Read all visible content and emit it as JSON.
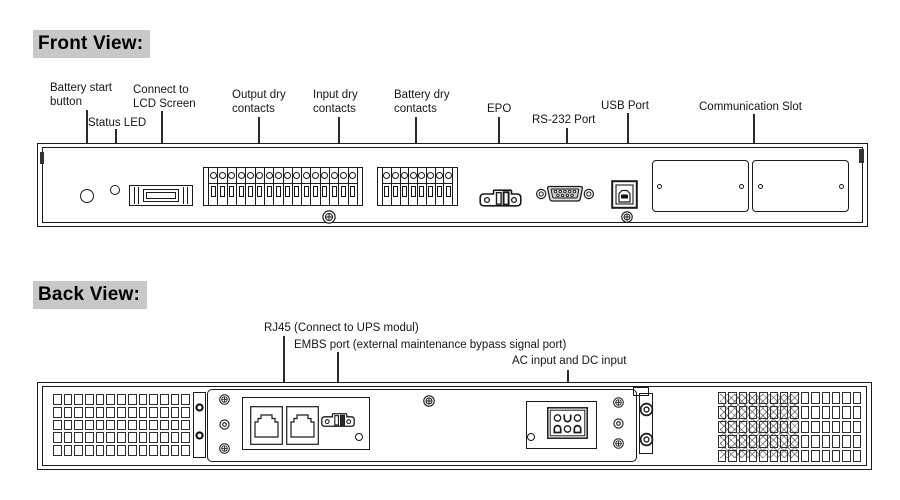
{
  "front": {
    "heading": "Front View:",
    "labels": {
      "battery_start": "Battery start\nbutton",
      "status_led": "Status LED",
      "lcd": "Connect to\nLCD Screen",
      "output_dry": "Output dry\ncontacts",
      "input_dry": "Input dry\ncontacts",
      "battery_dry": "Battery dry\ncontacts",
      "epo": "EPO",
      "rs232": "RS-232 Port",
      "usb": "USB Port",
      "comm_slot": "Communication Slot"
    },
    "output_input_block": {
      "terminals": 16
    },
    "battery_block": {
      "terminals": 8
    },
    "communication_slots": 2
  },
  "back": {
    "heading": "Back View:",
    "labels": {
      "rj45": "RJ45 (Connect to UPS modul)",
      "embs": "EMBS port (external maintenance bypass signal port)",
      "ac_dc": "AC input and DC input"
    },
    "rj45_ports": 2,
    "left_vent": {
      "cols": 13,
      "rows": 5
    },
    "right_vent": {
      "cols": 14,
      "rows": 5
    }
  },
  "colors": {
    "line": "#1a1a1a",
    "heading_bg": "#c8c8c8",
    "page_bg": "#ffffff"
  }
}
